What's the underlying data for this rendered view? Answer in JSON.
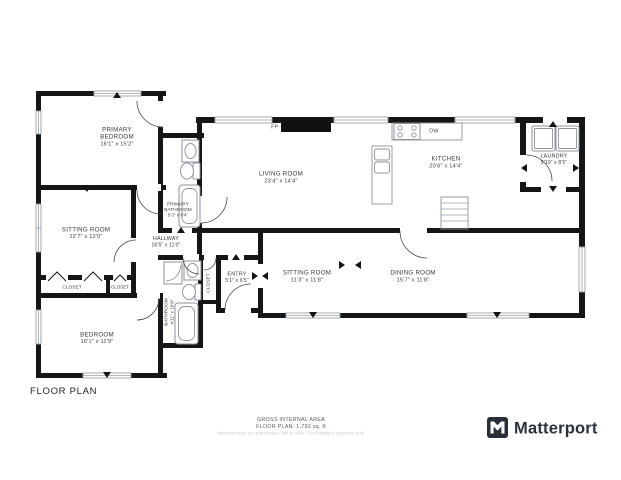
{
  "title": "FLOOR PLAN",
  "footer": {
    "area_label": "GROSS INTERNAL AREA",
    "area_value": "FLOOR PLAN: 1,792 sq. ft",
    "disclaimer": "Measurements are approximate. Not to scale. For illustrative purposes only."
  },
  "brand": {
    "name": "Matterport"
  },
  "annotations": {
    "fireplace": "FP",
    "dishwasher": "DW"
  },
  "rooms": {
    "primary_bedroom": {
      "name_l1": "PRIMARY",
      "name_l2": "BEDROOM",
      "dims": "16'1\" x 15'2\""
    },
    "primary_bathroom": {
      "name_l1": "PRIMARY",
      "name_l2": "BATHROOM",
      "dims": "5'3\" x 8'4\""
    },
    "hallway": {
      "name": "HALLWAY",
      "dims": "16'5\" x 11'0\""
    },
    "sitting_room_1": {
      "name": "SITTING ROOM",
      "dims": "12'7\" x 12'0\""
    },
    "closet_1": {
      "name": "CLOSET"
    },
    "closet_2": {
      "name": "CLOSET"
    },
    "closet_3": {
      "name": "CLOSET"
    },
    "bedroom": {
      "name": "BEDROOM",
      "dims": "16'1\" x 11'9\""
    },
    "bathroom": {
      "name": "BATHROOM",
      "dims": "4'11\" x 10'8\""
    },
    "entry": {
      "name": "ENTRY",
      "dims": "5'1\" x 6'5\""
    },
    "living_room": {
      "name": "LIVING ROOM",
      "dims": "23'4\" x 14'4\""
    },
    "kitchen": {
      "name": "KITCHEN",
      "dims": "20'6\" x 14'4\""
    },
    "laundry": {
      "name": "LAUNDRY",
      "dims": "5'10\" x 8'5\""
    },
    "sitting_room_2": {
      "name": "SITTING ROOM",
      "dims": "11'3\" x 11'8\""
    },
    "dining_room": {
      "name": "DINING ROOM",
      "dims": "15'7\" x 11'8\""
    }
  }
}
